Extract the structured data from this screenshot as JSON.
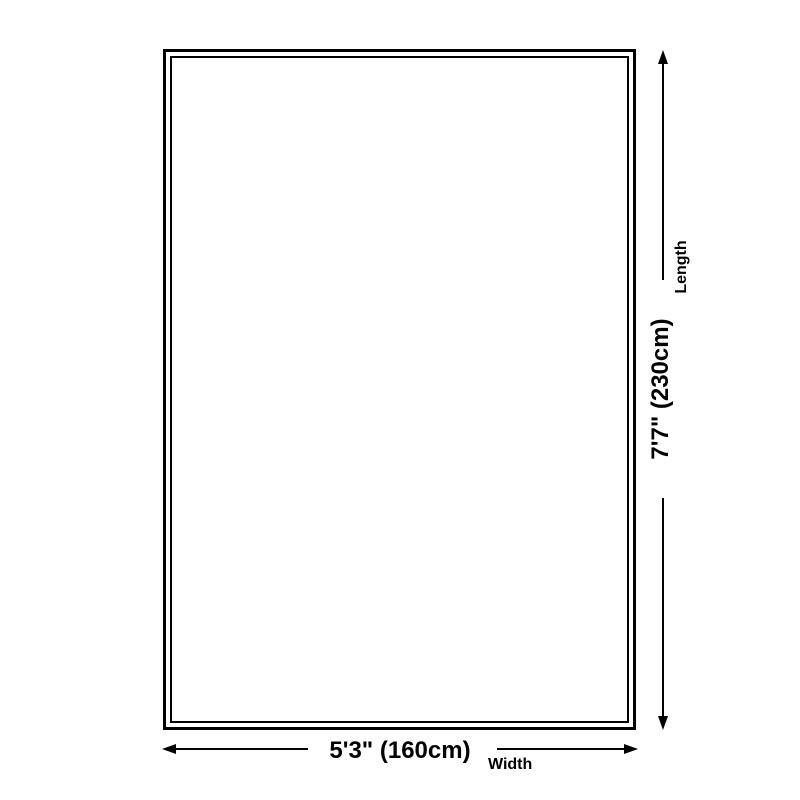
{
  "diagram": {
    "background": "#ffffff",
    "line_color": "#000000",
    "width_dimension": {
      "value": "5'3\" (160cm)",
      "label": "Width"
    },
    "length_dimension": {
      "value": "7'7\" (230cm)",
      "label": "Length"
    }
  }
}
